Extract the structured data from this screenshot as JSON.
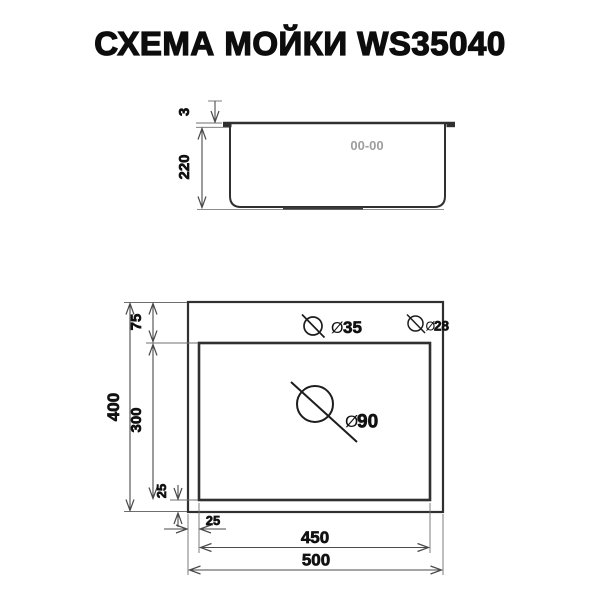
{
  "title": "СХЕМА МОЙКИ WS35040",
  "model": "WS35040",
  "side_view": {
    "rim_thickness": "3",
    "depth": "220",
    "logo_mark": "00-00"
  },
  "top_view": {
    "deck_offset": "75",
    "overall_depth": "400",
    "bowl_depth": "300",
    "bowl_bottom_margin": "25",
    "bowl_side_margin": "25",
    "bowl_width": "450",
    "overall_width": "500",
    "diameter_symbol": "Ø",
    "faucet_hole_diameter": "35",
    "accessory_hole_diameter": "28",
    "drain_hole_diameter": "90"
  },
  "colors": {
    "background": "#ffffff",
    "drawing_line": "#303030",
    "dimension_line": "#4a4a4a",
    "label_text": "#111111",
    "logo_gray": "#9e9e9e"
  }
}
